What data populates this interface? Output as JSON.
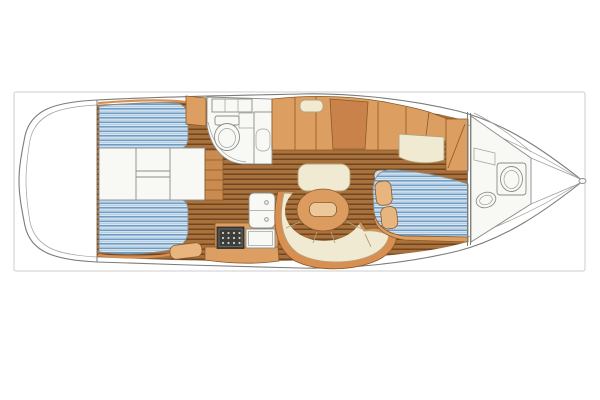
{
  "meta": {
    "figure_type": "sailing-yacht interior layout plan",
    "view": "overhead floor plan drawing",
    "bow_direction": "right",
    "stern_direction": "left",
    "visible_text": ""
  },
  "colors": {
    "background": "#ffffff",
    "frame_border": "#cccccc",
    "hull_fill": "#ffffff",
    "hull_outline": "#7b7b78",
    "wood_floor": "#a9713c",
    "wood_plank_line": "#70451f",
    "mattress_base": "#dde9f3",
    "mattress_stripe": "#6f9cc4",
    "mattress_stripe_light": "#aac6de",
    "fixture_white": "#f8f8f5",
    "cabinet_tan": "#dd9e62",
    "cabinet_tan_dark": "#c9834a",
    "trim_orange": "#d98e52",
    "cushion_cream": "#f0ead2",
    "pillow_tan": "#e9b57e",
    "steps_wood": "#c98b4f",
    "stove_dark": "#3c3c38",
    "stove_burner_dot": "#cfcfc8",
    "table_wood": "#dd9c5f",
    "table_inset": "#ecc89a",
    "mast_gray": "#d8d8d4"
  },
  "areas": [
    {
      "id": "stern-deck",
      "label": "rounded stern / transom deck"
    },
    {
      "id": "aft-cabin-port",
      "label": "aft double berth, port side"
    },
    {
      "id": "aft-cabin-starboard",
      "label": "aft double berth, starboard side"
    },
    {
      "id": "engine-compartment",
      "label": "engine compartment between aft berths"
    },
    {
      "id": "companionway-steps",
      "label": "companionway steps"
    },
    {
      "id": "aft-head",
      "label": "aft head with toilet, sink and lockers"
    },
    {
      "id": "galley",
      "label": "galley with double sink, stove and counters"
    },
    {
      "id": "saloon",
      "label": "saloon with curved settee and round table"
    },
    {
      "id": "nav-station",
      "label": "port sideboard / chart table with seat cushion"
    },
    {
      "id": "mast-step",
      "label": "mast step"
    },
    {
      "id": "forward-cabin",
      "label": "forward cabin with angled double berth, seat and wardrobe"
    },
    {
      "id": "forward-head",
      "label": "forward head with toilet and sink"
    },
    {
      "id": "anchor-locker",
      "label": "anchor locker at bow"
    }
  ]
}
